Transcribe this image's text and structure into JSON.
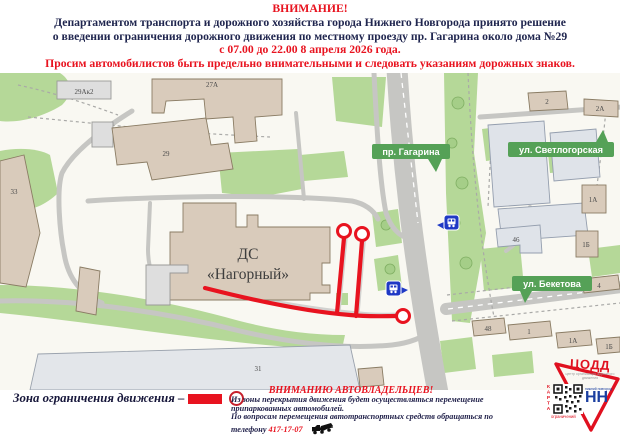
{
  "header": {
    "line1": "ВНИМАНИЕ!",
    "line2": "Департаментом транспорта и дорожного хозяйства города Нижнего Новгорода принято решение",
    "line3": "о введении ограничения дорожного движения по местному проезду пр. Гагарина около дома №29",
    "line4": "с 07.00 до 22.00 8 апреля 2026 года.",
    "line5": "Просим автомобилистов быть предельно внимательными и следовать указаниям дорожных знаков."
  },
  "map": {
    "streets": {
      "gagarina": "пр. Гагарина",
      "svetlogorskaya": "ул. Светлогорская",
      "beketova": "ул. Бекетова"
    },
    "venue": {
      "line1": "ДС",
      "line2": "«Нагорный»"
    },
    "buildings": {
      "b29ak2": "29Ак2",
      "b27a": "27А",
      "b29": "29",
      "b33": "33",
      "b2": "2",
      "b2a": "2А",
      "b1a_r": "1А",
      "b46": "46",
      "b1b_r": "1Б",
      "b4": "4",
      "b48": "48",
      "b1": "1",
      "b1a_b": "1А",
      "b1b_b": "1Б",
      "b31": "31"
    }
  },
  "legend": {
    "label": "Зона ограничения движения –"
  },
  "notice": {
    "title": "ВНИМАНИЮ АВТОВЛАДЕЛЬЦЕВ!",
    "body1": "Из зоны перекрытия движения будет осуществляться перемещение",
    "body2": "припаркованных автомобилей.",
    "body3": "По вопросам перемещения автотранспортных средств обращаться по",
    "body4": "телефону",
    "phone": "417-17-07"
  },
  "logo": {
    "org": "ЦОДД",
    "org_sub": "центр организации дорожного движения",
    "qr_side": "КАРТА",
    "qr_bottom": "ограничений",
    "city": "НН",
    "city_sub": "нижний новгород"
  },
  "colors": {
    "accent_red": "#e8131f",
    "navy": "#20264f",
    "label_green": "#55a157",
    "map_green": "#b5d898",
    "road_grey": "#c6c6c3",
    "bus_blue": "#1f39c5"
  }
}
